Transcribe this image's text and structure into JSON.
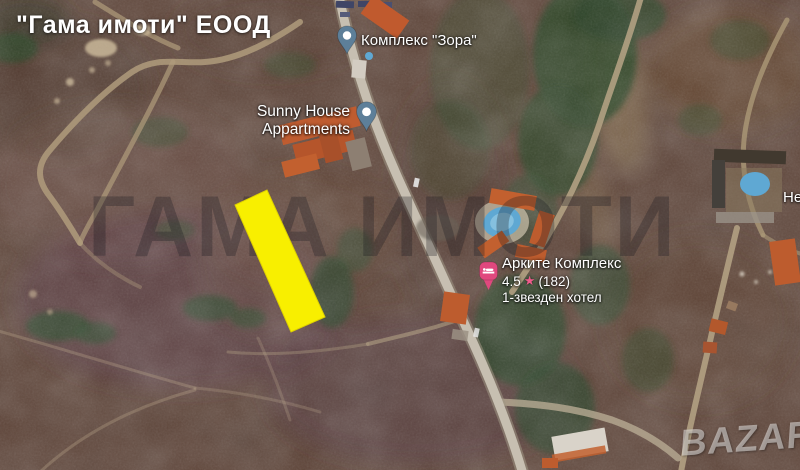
{
  "header": {
    "title": "\"Гама имоти\" ЕООД"
  },
  "watermarks": {
    "agency": "ГАМА ИМОТИ",
    "bazar": "BAZAR"
  },
  "map": {
    "poi": {
      "zora": {
        "label": "Комплекс \"Зора\""
      },
      "sunny_house": {
        "line1": "Sunny House",
        "line2": "Appartments"
      },
      "arkite": {
        "name": "Арките Комплекс",
        "rating": "4.5",
        "star_icon": "★",
        "reviews": "(182)",
        "category": "1-звезден хотел"
      },
      "edge_cut": {
        "label": "Не"
      }
    },
    "colors": {
      "parcel_fill": "#f8ef00",
      "parcel_stroke": "#ddd000",
      "poi_pin": "#5d7f99",
      "hotel_pin": "#e0487e",
      "star": "#ef5b8b",
      "pool": "#5fa8d3",
      "roof": "#c2602f"
    }
  }
}
